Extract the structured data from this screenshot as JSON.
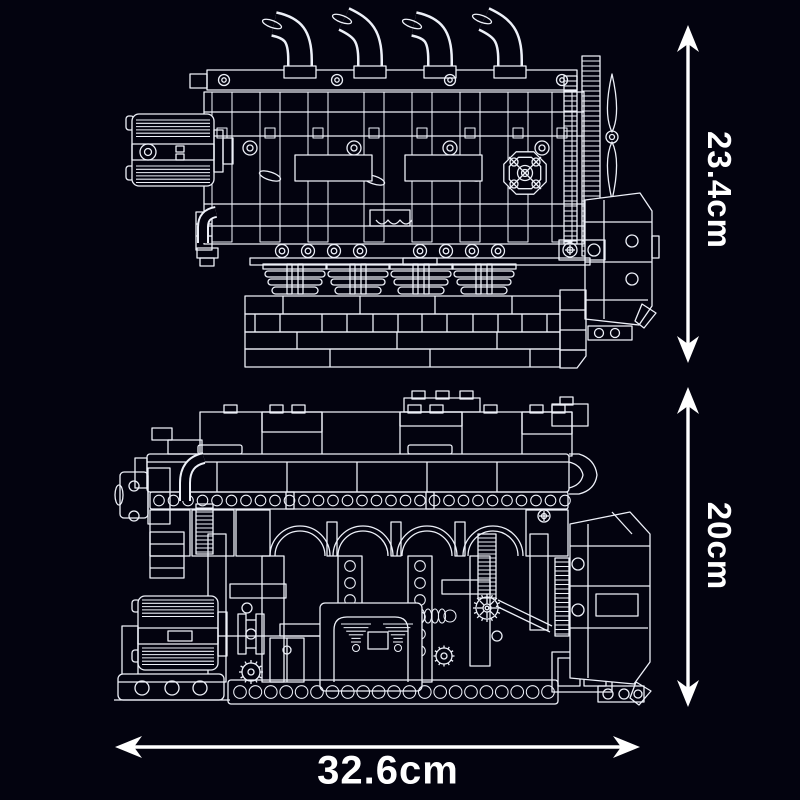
{
  "figure": {
    "background_color": "#03030f",
    "line_color": "#edf0f8",
    "arrow_color": "#ffffff",
    "views": {
      "front": {
        "name": "engine-front-view"
      },
      "side": {
        "name": "engine-side-view"
      }
    },
    "dimensions": {
      "front_height": {
        "label": "23.4cm"
      },
      "side_height": {
        "label": "20cm"
      },
      "width": {
        "label": "32.6cm"
      }
    }
  }
}
